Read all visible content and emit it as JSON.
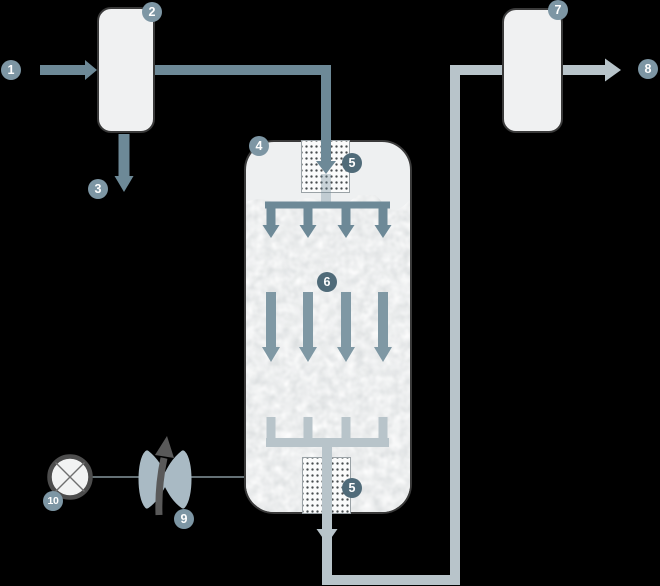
{
  "badges": [
    {
      "label": "1",
      "variant": "light"
    },
    {
      "label": "2",
      "variant": "light"
    },
    {
      "label": "3",
      "variant": "light"
    },
    {
      "label": "4",
      "variant": "light"
    },
    {
      "label": "5",
      "variant": "dark"
    },
    {
      "label": "6",
      "variant": "dark"
    },
    {
      "label": "5",
      "variant": "dark"
    },
    {
      "label": "7",
      "variant": "light"
    },
    {
      "label": "8",
      "variant": "light"
    },
    {
      "label": "9",
      "variant": "light"
    },
    {
      "label": "10",
      "variant": "light"
    }
  ],
  "icons": {
    "pump": "pump-icon",
    "valve": "valve-icon",
    "flow_arrows": "arrow-icons"
  },
  "colors": {
    "background": "#000000",
    "vessel_fill": "#f0f1f2",
    "vessel_border": "#3a3a3a",
    "pipe_dark": "#6d8997",
    "pipe_mid": "#7f98a4",
    "pipe_light": "#b8c4ca",
    "badge_light": "#7d96a4",
    "badge_dark": "#506b79",
    "valve": "#a9bac4",
    "dark_arrow": "#595959",
    "media_base": "#dcdfe0",
    "grid_dot": "#474c4f"
  }
}
